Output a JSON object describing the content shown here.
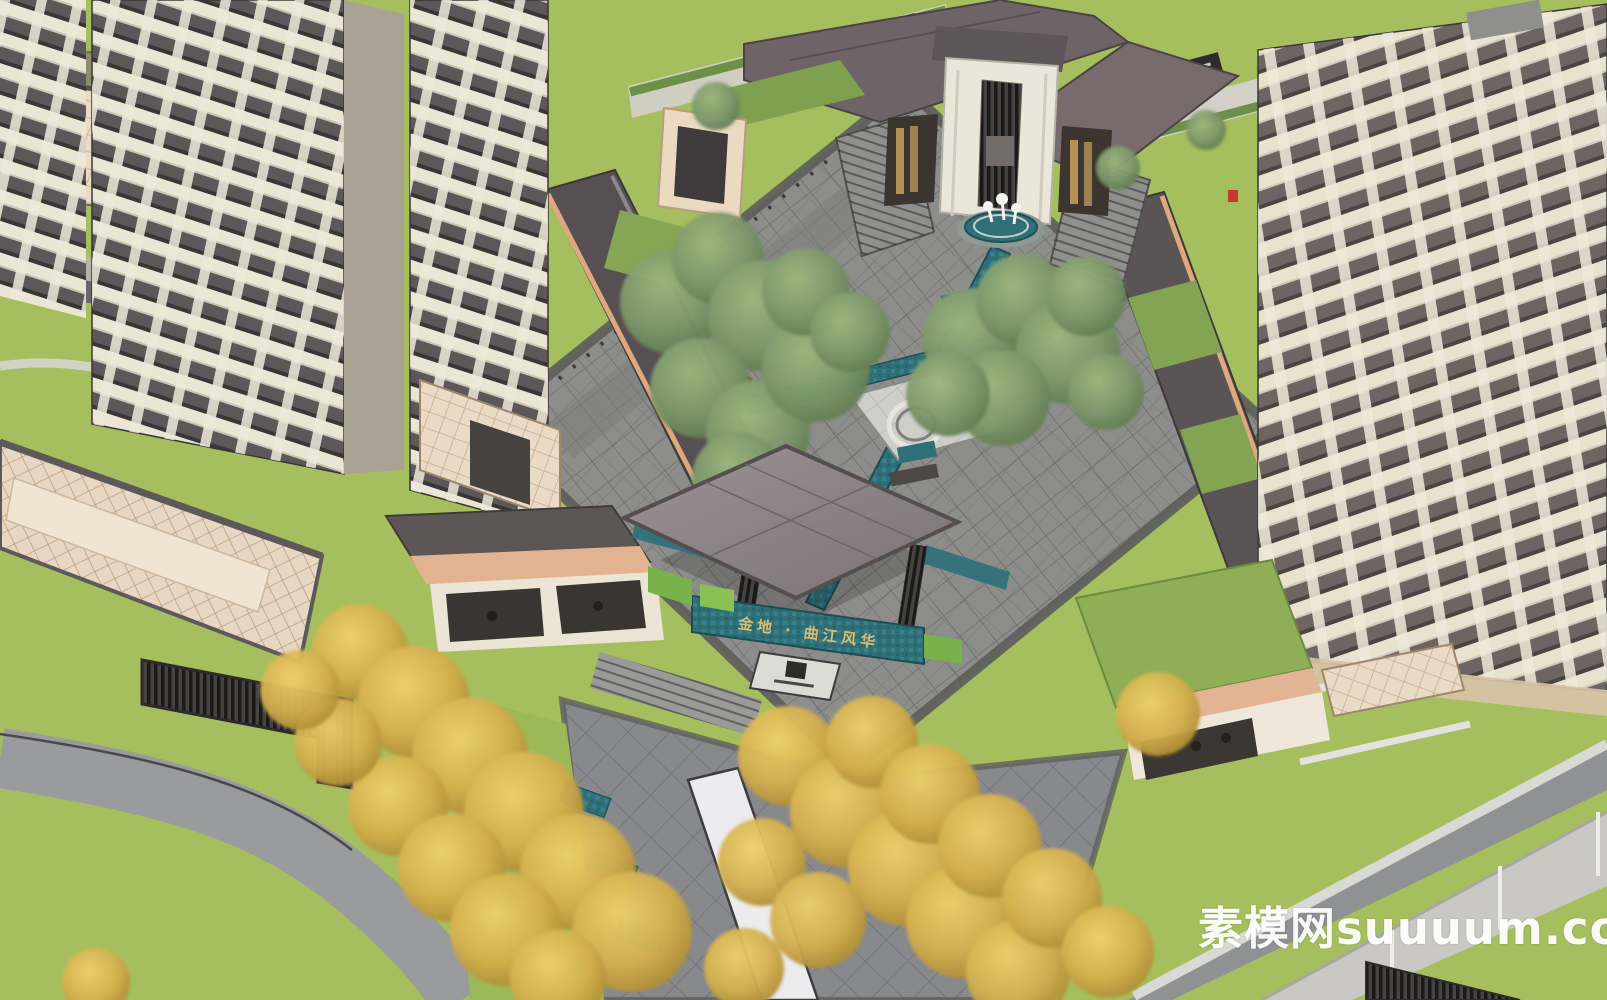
{
  "scene": {
    "type": "aerial-axonometric-architectural-render",
    "subject": "Residential community entrance: central landscaped courtyard with water axis, clubhouse, gate canopy and residential towers",
    "signs": {
      "gate_sign": "金地 · 曲江风华"
    },
    "watermark": {
      "text": "素模网suuuum.com"
    },
    "palette": {
      "lawn": "#a6bf5e",
      "road": "#9a9b9d",
      "paving": "#8d8e8c",
      "water": "#2f7078",
      "canopy": "#8b8185",
      "roof_dark": "#6e6367",
      "facade_cream": "#ebe5d4",
      "facade_dark": "#5d5759",
      "tile_beige": "#eadbc7",
      "fascia_salmon": "#dfa87e",
      "tree_green": "#7d976a",
      "tree_yellow": "#d4af4e",
      "sign_gold": "#d9bd72",
      "marble": "#ececee",
      "watermark_white": "#ffffff"
    },
    "vegetation": {
      "green_trees": [
        [
          672,
          302,
          52
        ],
        [
          718,
          258,
          46
        ],
        [
          764,
          316,
          56
        ],
        [
          700,
          388,
          50
        ],
        [
          758,
          432,
          52
        ],
        [
          816,
          368,
          54
        ],
        [
          806,
          292,
          44
        ],
        [
          850,
          332,
          40
        ],
        [
          738,
          478,
          46
        ],
        [
          792,
          508,
          42
        ],
        [
          972,
          338,
          50
        ],
        [
          1022,
          300,
          46
        ],
        [
          1068,
          352,
          52
        ],
        [
          1002,
          398,
          48
        ],
        [
          1086,
          296,
          40
        ],
        [
          948,
          394,
          42
        ],
        [
          1106,
          392,
          38
        ],
        [
          716,
          106,
          24
        ],
        [
          1118,
          168,
          22
        ],
        [
          1206,
          130,
          20
        ]
      ],
      "yellow_trees": [
        [
          360,
          652,
          48
        ],
        [
          414,
          702,
          56
        ],
        [
          470,
          756,
          58
        ],
        [
          524,
          812,
          60
        ],
        [
          578,
          872,
          58
        ],
        [
          632,
          932,
          60
        ],
        [
          398,
          806,
          50
        ],
        [
          452,
          868,
          54
        ],
        [
          506,
          930,
          56
        ],
        [
          558,
          978,
          48
        ],
        [
          338,
          742,
          44
        ],
        [
          300,
          690,
          40
        ],
        [
          96,
          982,
          34
        ],
        [
          788,
          756,
          50
        ],
        [
          846,
          812,
          56
        ],
        [
          906,
          868,
          58
        ],
        [
          962,
          922,
          56
        ],
        [
          1018,
          972,
          52
        ],
        [
          872,
          742,
          46
        ],
        [
          930,
          794,
          50
        ],
        [
          990,
          846,
          52
        ],
        [
          1052,
          898,
          50
        ],
        [
          1108,
          952,
          46
        ],
        [
          762,
          862,
          44
        ],
        [
          818,
          920,
          48
        ],
        [
          744,
          968,
          40
        ],
        [
          1158,
          714,
          42
        ]
      ]
    },
    "landmarks": [
      "left residential towers",
      "right residential tower",
      "clubhouse with portal tower",
      "crane fountain",
      "central courtyard",
      "ring sculpture plaza",
      "water axis channel",
      "entrance gate canopy",
      "gate sign wall",
      "ground logo plaque",
      "approach promenade",
      "marble water strip",
      "ginkgo tree rows",
      "perimeter roads and walls"
    ]
  }
}
